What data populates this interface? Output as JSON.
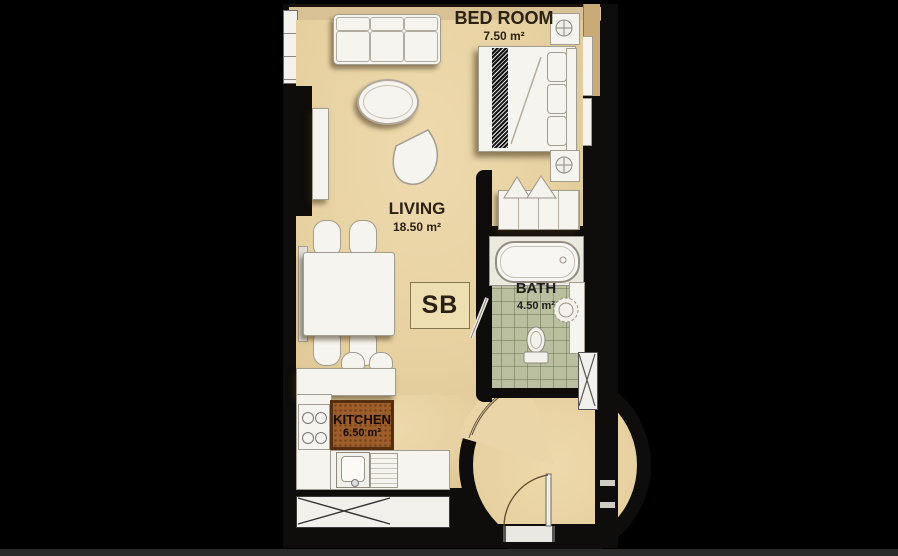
{
  "plan": {
    "unit_label": "SB",
    "rooms": {
      "bedroom": {
        "name": "BED ROOM",
        "area": "7.50 m²"
      },
      "living": {
        "name": "LIVING",
        "area": "18.50 m²"
      },
      "bath": {
        "name": "BATH",
        "area": "4.50 m²"
      },
      "kitchen": {
        "name": "KITCHEN",
        "area": "6.50 m²"
      }
    },
    "colors": {
      "background": "#000000",
      "floor_tan": "#e9d4a6",
      "bath_tile": "#b9bf9f",
      "wall_black": "#0e0d0b",
      "kitchen_patch": "#9d5e2b",
      "label_text": "#2b2213"
    }
  }
}
